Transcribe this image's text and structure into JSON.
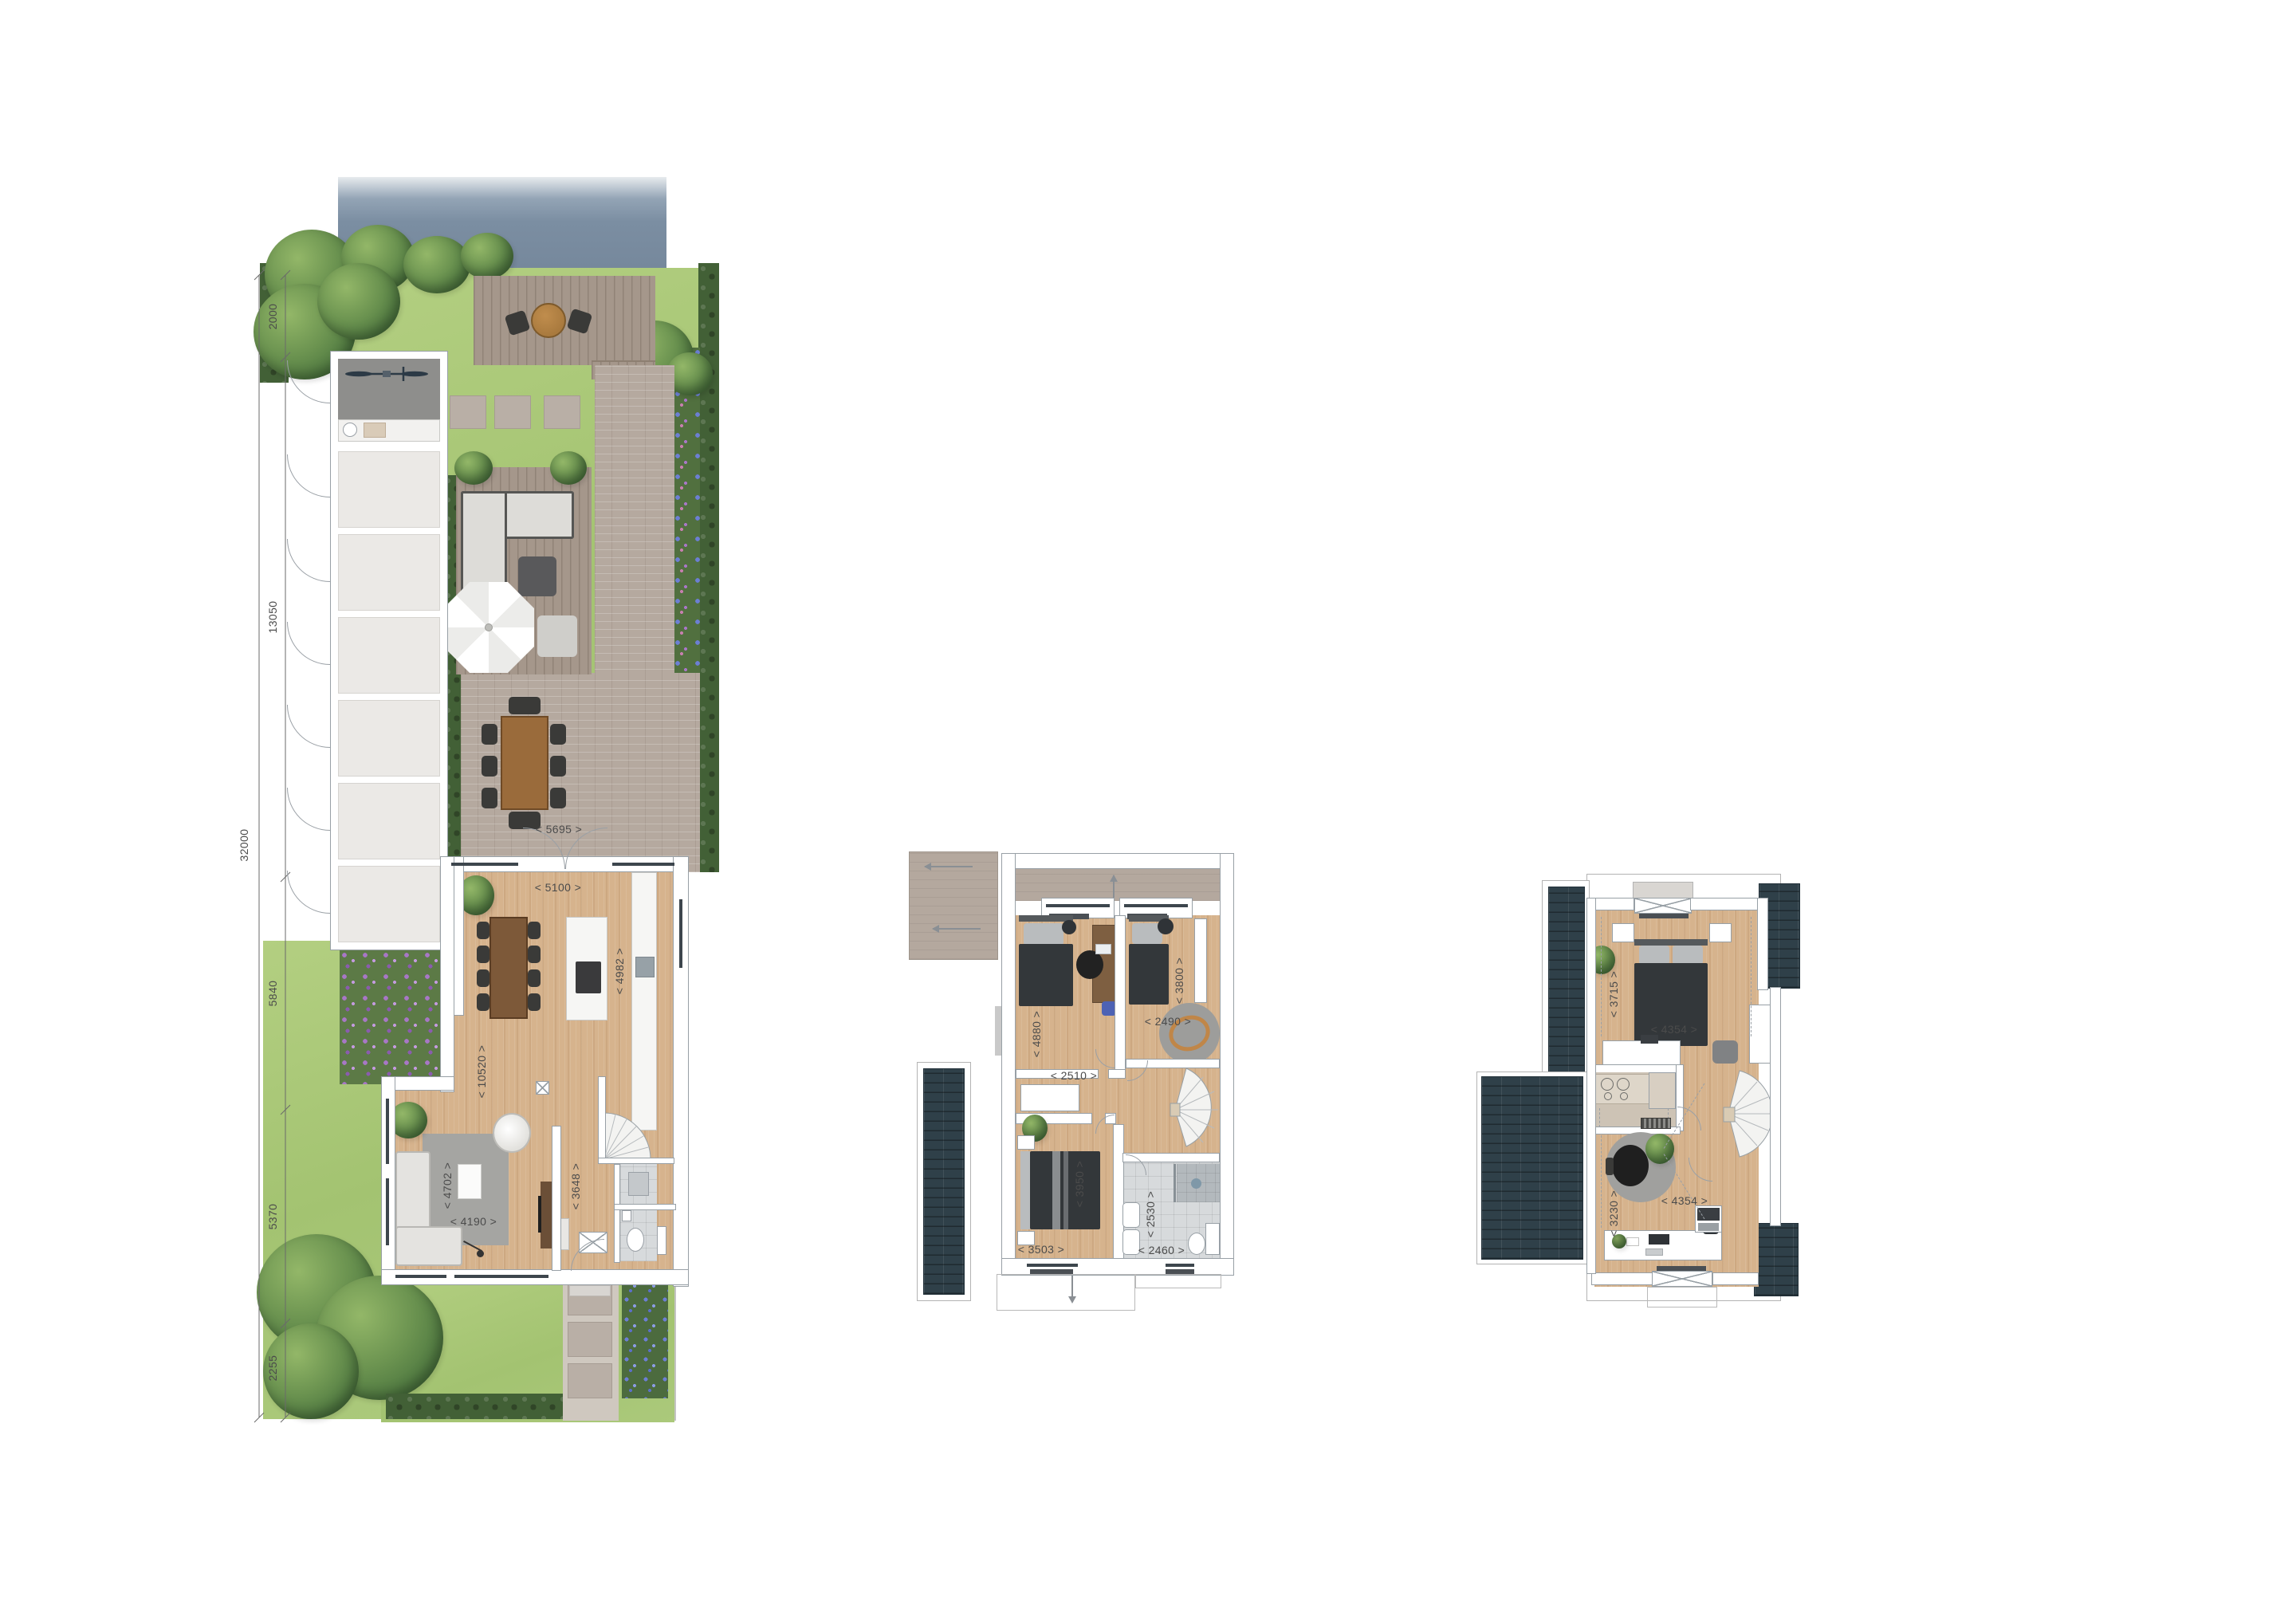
{
  "title": "three-level floor plan set: site/ground floor, first floor, attic floor",
  "site_plan": {
    "overall": "32000",
    "segments": [
      "2000",
      "13050",
      "5840",
      "5370",
      "2255"
    ],
    "labels": {
      "patio_width": "< 5695 >",
      "kitchen_width": "< 5100 >",
      "kitchen_depth": "< 4982 >",
      "living_length": "< 10520 >",
      "living_width": "< 4702 >",
      "rug_width": "< 4190 >",
      "hall_depth": "< 3648 >"
    }
  },
  "first_floor": {
    "labels": {
      "bedroom1_depth": "< 4880 >",
      "bedroom1_width": "< 2510 >",
      "bedroom2_depth": "< 3800 >",
      "bedroom2_width": "< 2490 >",
      "master_depth": "< 3950 >",
      "master_width": "< 3503 >",
      "bathroom_depth": "< 2530 >",
      "bathroom_width": "< 2460 >"
    }
  },
  "attic": {
    "labels": {
      "bedroom_depth": "< 3715 >",
      "bedroom_width": "< 4354 >",
      "study_depth": "< 3230 >",
      "study_width": "< 4354 >"
    }
  },
  "colors": {
    "water": "#7b8ea2",
    "lawn": "#abc97b",
    "hedge": "#426036",
    "deck_wood": "#a5978b",
    "patio_brick": "#b5a99f",
    "floor_wood": "#d6b38d",
    "roof_dark": "#2f4049",
    "roof_beige": "#b4a89e",
    "bath_tile": "#d7dadc",
    "wall_line": "#98a0a6",
    "dim_text": "#4b4b4b",
    "duvet_dark": "#33373a",
    "toy_track_orange": "#c08648",
    "flower_purple": "#a877c6",
    "flower_blue": "#6c7fd4"
  }
}
